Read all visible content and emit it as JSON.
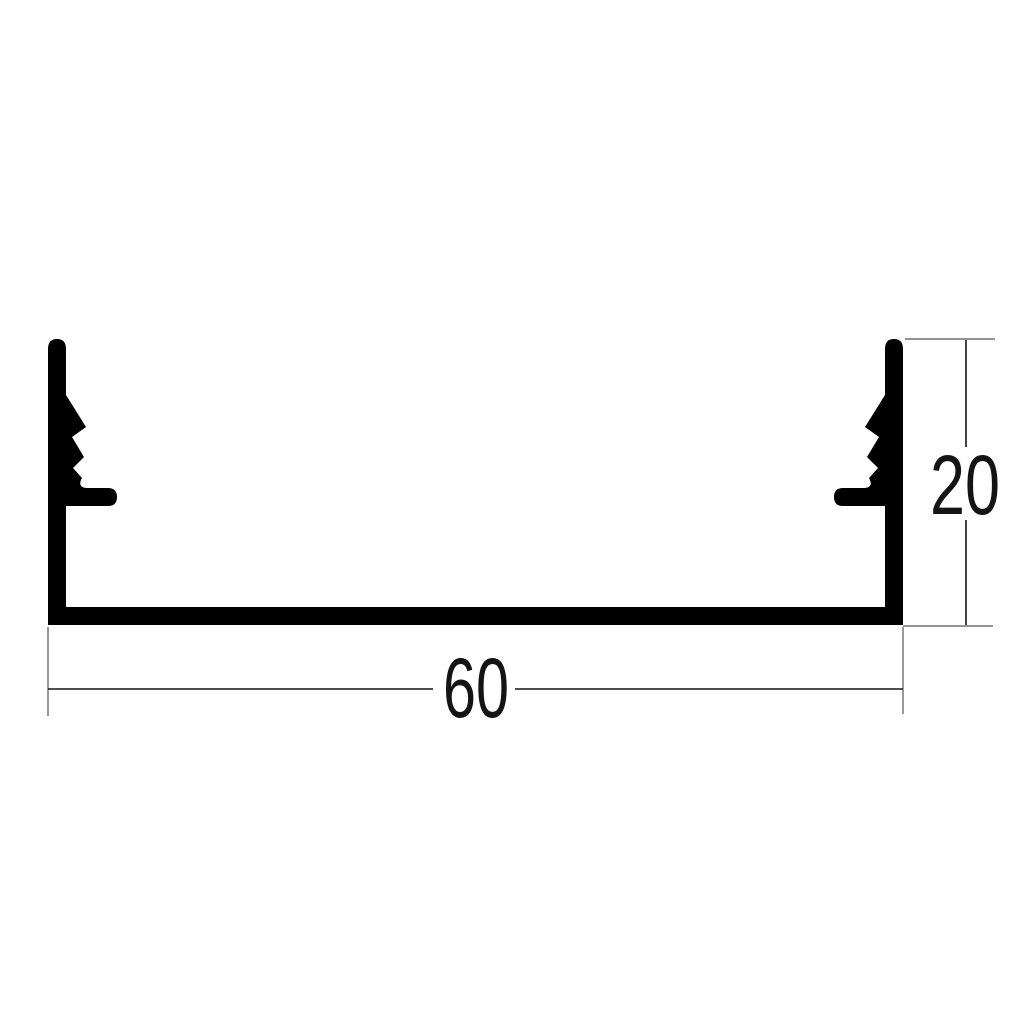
{
  "page": {
    "background": "#ffffff",
    "description": "technical drawing of extruded profile cross-section"
  },
  "drawing": {
    "colors": {
      "profile_fill": "#000000",
      "dimension_line": "#141414",
      "extension_line": "#555555",
      "text": "#141414"
    },
    "dimensions": {
      "width": {
        "value": "60"
      },
      "height": {
        "value": "20"
      }
    }
  }
}
